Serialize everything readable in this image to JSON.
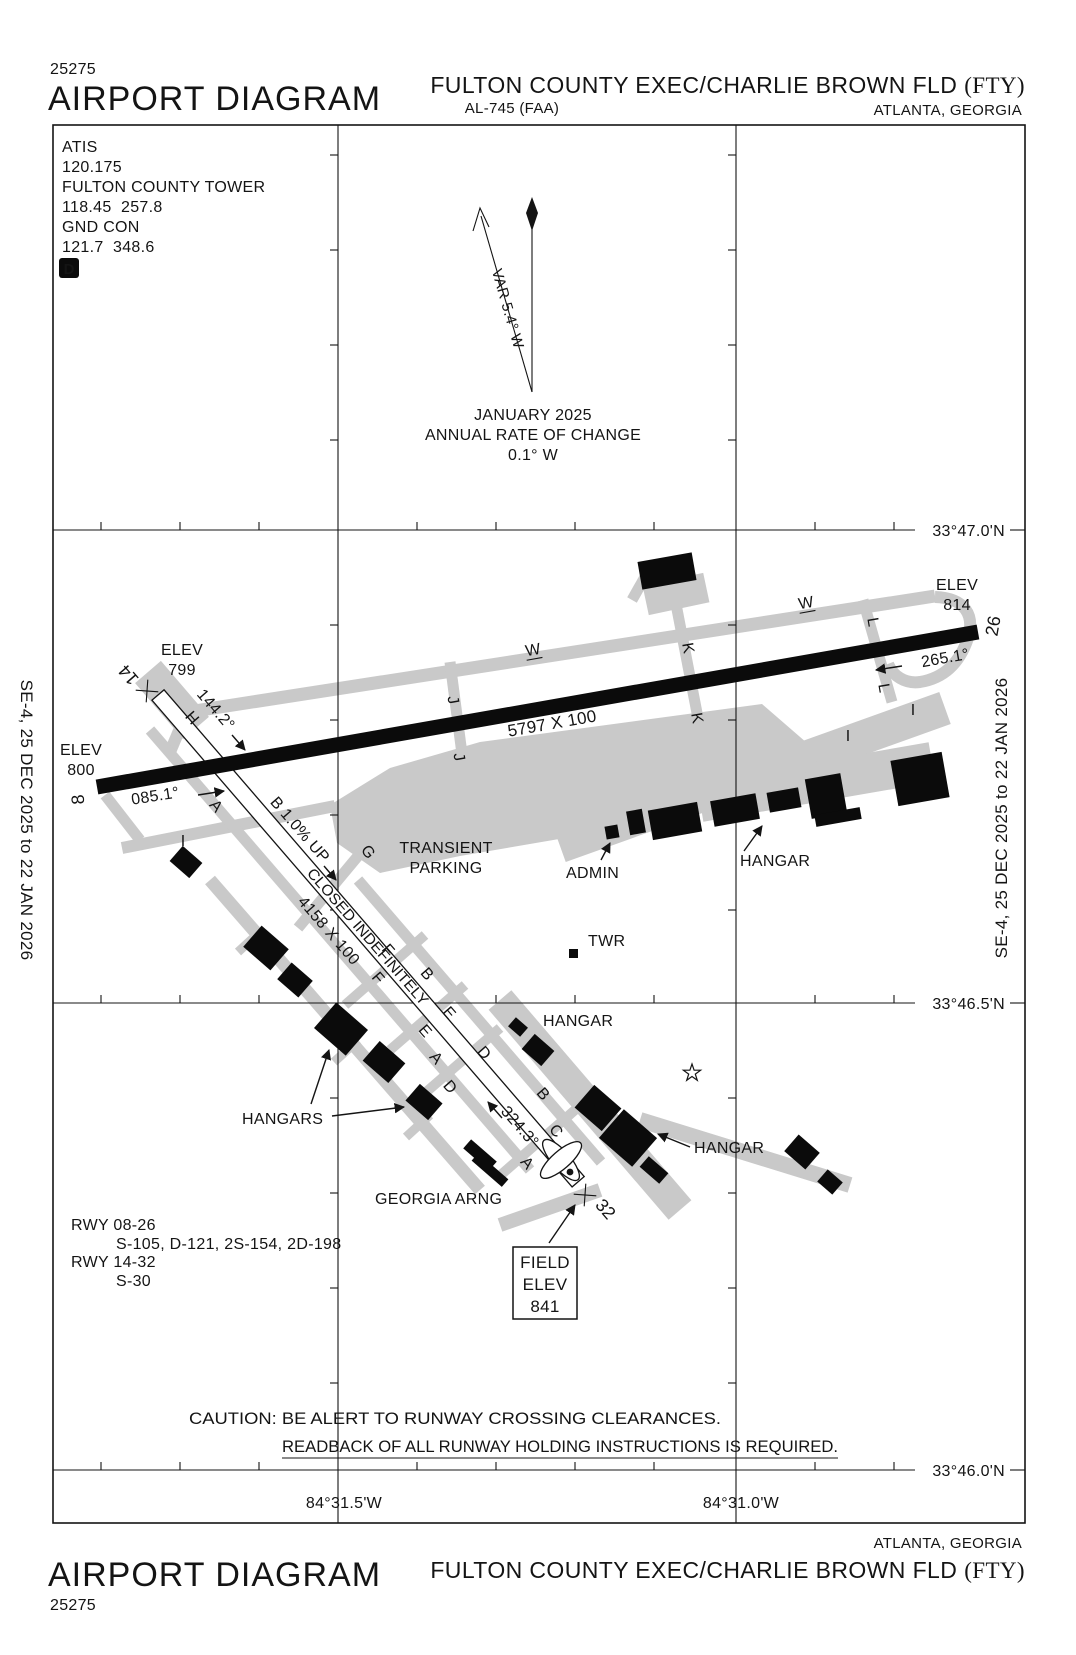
{
  "header": {
    "chart_number": "25275",
    "doc_title": "AIRPORT DIAGRAM",
    "airport_name": "FULTON COUNTY EXEC/CHARLIE BROWN FLD",
    "airport_id": "(FTY)",
    "procedure_code": "AL-745 (FAA)",
    "city": "ATLANTA, GEORGIA"
  },
  "footer": {
    "chart_number": "25275",
    "doc_title": "AIRPORT DIAGRAM",
    "airport_name": "FULTON COUNTY EXEC/CHARLIE BROWN FLD",
    "airport_id": "(FTY)",
    "city": "ATLANTA, GEORGIA"
  },
  "edge_dates": {
    "left": "SE-4,  25 DEC 2025  to  22 JAN 2026",
    "right": "SE-4,  25 DEC 2025  to  22 JAN 2026"
  },
  "comms": {
    "atis_label": "ATIS",
    "atis_freq": "120.175",
    "tower_name": "FULTON COUNTY TOWER",
    "tower_freqs": "118.45  257.8",
    "ground_label": "GND CON",
    "ground_freqs": "121.7  348.6",
    "datis_badge": "D"
  },
  "compass": {
    "variation": "VAR 5.4° W",
    "date": "JANUARY 2025",
    "rate_label": "ANNUAL RATE OF CHANGE",
    "rate_value": "0.1° W"
  },
  "grid": {
    "latitudes": [
      "33°47.0'N",
      "33°46.5'N",
      "33°46.0'N"
    ],
    "longitudes": [
      "84°31.5'W",
      "84°31.0'W"
    ]
  },
  "runway_08_26": {
    "dimensions": "5797 X 100",
    "end_left_number": "8",
    "end_right_number": "26",
    "heading_left": "085.1°",
    "heading_right": "265.1°",
    "elev_label_left": "ELEV",
    "elev_left": "800",
    "elev_label_right": "ELEV",
    "elev_right": "814"
  },
  "runway_14_32": {
    "dimensions": "4158 X 100",
    "status": "CLOSED INDEFINITELY",
    "gradient": "B 1.0% UP",
    "end_upper_number": "14",
    "end_lower_number": "32",
    "heading_upper": "144.2°",
    "heading_lower": "324.3°",
    "elev_label_upper": "ELEV",
    "elev_upper": "799"
  },
  "field_elevation": {
    "line1": "FIELD",
    "line2": "ELEV",
    "value": "841"
  },
  "site_labels": {
    "transient_line1": "TRANSIENT",
    "transient_line2": "PARKING",
    "admin": "ADMIN",
    "tower": "TWR",
    "hangar_north": "HANGAR",
    "hangar_mid": "HANGAR",
    "hangar_south": "HANGAR",
    "hangars_west": "HANGARS",
    "georgia_arng": "GEORGIA ARNG"
  },
  "runway_data": {
    "rwy1_label": "RWY 08-26",
    "rwy1_values": "S-105, D-121, 2S-154, 2D-198",
    "rwy2_label": "RWY 14-32",
    "rwy2_values": "S-30"
  },
  "caution": {
    "line1": "CAUTION: BE ALERT TO RUNWAY CROSSING CLEARANCES.",
    "line2": "READBACK OF ALL RUNWAY HOLDING INSTRUCTIONS IS REQUIRED."
  },
  "taxiway_labels": [
    {
      "t": "W",
      "x": 533,
      "y": 650,
      "r": -10,
      "u": true
    },
    {
      "t": "W",
      "x": 806,
      "y": 603,
      "r": -10,
      "u": true
    },
    {
      "t": "J",
      "x": 453,
      "y": 700,
      "r": 80
    },
    {
      "t": "J",
      "x": 459,
      "y": 757,
      "r": 80
    },
    {
      "t": "K",
      "x": 688,
      "y": 648,
      "r": 80
    },
    {
      "t": "K",
      "x": 697,
      "y": 718,
      "r": 80
    },
    {
      "t": "L",
      "x": 873,
      "y": 622,
      "r": 80
    },
    {
      "t": "L",
      "x": 884,
      "y": 688,
      "r": 80
    },
    {
      "t": "I",
      "x": 913,
      "y": 710,
      "r": 0
    },
    {
      "t": "I",
      "x": 848,
      "y": 736,
      "r": 0
    },
    {
      "t": "I",
      "x": 183,
      "y": 841,
      "r": 0
    },
    {
      "t": "H",
      "x": 192,
      "y": 718,
      "r": 49
    },
    {
      "t": "A",
      "x": 216,
      "y": 806,
      "r": 49
    },
    {
      "t": "G",
      "x": 368,
      "y": 852,
      "r": 52
    },
    {
      "t": "F",
      "x": 388,
      "y": 950,
      "r": 49
    },
    {
      "t": "F",
      "x": 378,
      "y": 978,
      "r": 49
    },
    {
      "t": "B",
      "x": 427,
      "y": 974,
      "r": 49
    },
    {
      "t": "E",
      "x": 449,
      "y": 1013,
      "r": 49
    },
    {
      "t": "E",
      "x": 425,
      "y": 1031,
      "r": 49
    },
    {
      "t": "A",
      "x": 436,
      "y": 1058,
      "r": 49
    },
    {
      "t": "D",
      "x": 484,
      "y": 1053,
      "r": 49
    },
    {
      "t": "D",
      "x": 450,
      "y": 1087,
      "r": 49
    },
    {
      "t": "B",
      "x": 543,
      "y": 1094,
      "r": 49
    },
    {
      "t": "C",
      "x": 556,
      "y": 1131,
      "r": 49
    },
    {
      "t": "A",
      "x": 527,
      "y": 1163,
      "r": 49
    }
  ]
}
